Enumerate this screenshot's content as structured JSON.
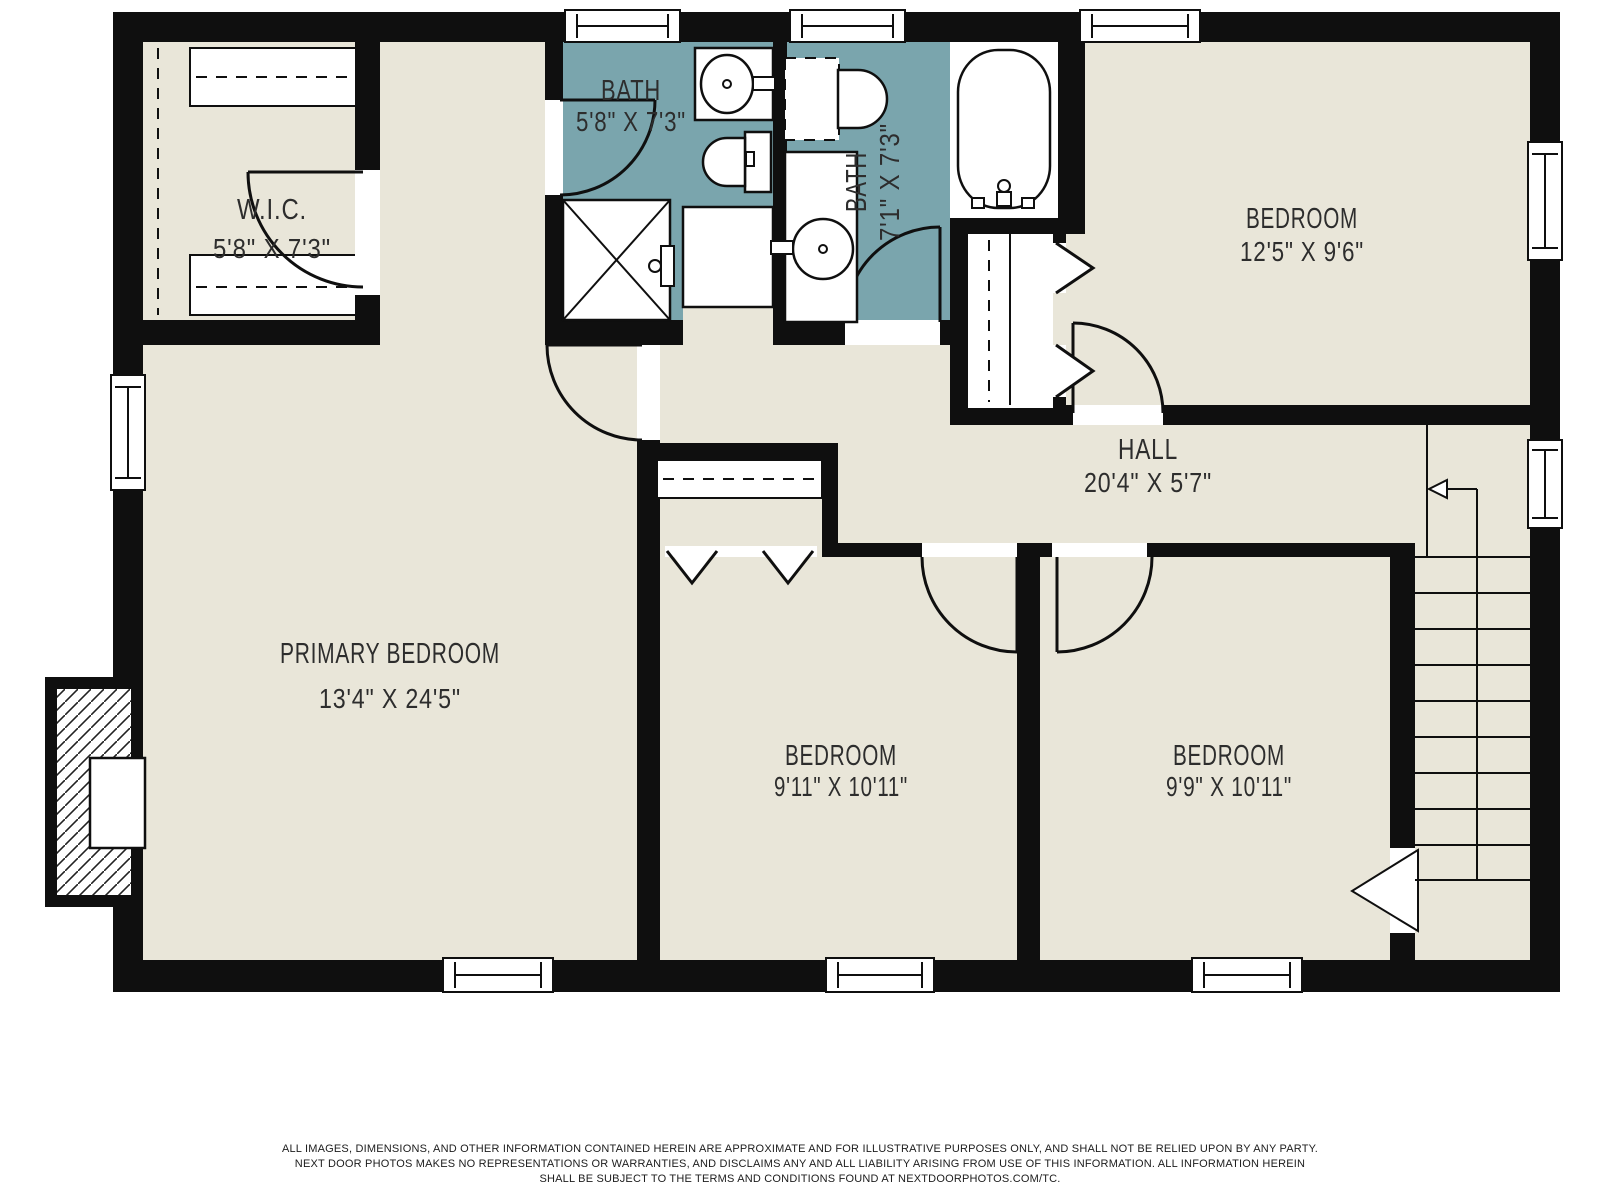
{
  "colors": {
    "wall": "#0f0f0f",
    "floor": "#e9e6d9",
    "bath": "#7aa5ad",
    "text": "#2d2d2d"
  },
  "rooms": {
    "wic": {
      "name": "W.I.C.",
      "dims": "5'8\" X 7'3\""
    },
    "bath1": {
      "name": "BATH",
      "dims": "5'8\" X 7'3\""
    },
    "bath2": {
      "name": "BATH",
      "dims": "7'1\" X 7'3\""
    },
    "bedroom_top": {
      "name": "BEDROOM",
      "dims": "12'5\" X 9'6\""
    },
    "hall": {
      "name": "HALL",
      "dims": "20'4\" X 5'7\""
    },
    "primary": {
      "name": "PRIMARY BEDROOM",
      "dims": "13'4\" X 24'5\""
    },
    "bedroom_mid": {
      "name": "BEDROOM",
      "dims": "9'11\" X 10'11\""
    },
    "bedroom_right": {
      "name": "BEDROOM",
      "dims": "9'9\" X 10'11\""
    }
  },
  "fixtures": [
    "sink",
    "toilet",
    "shower",
    "vanity-sink",
    "bathtub",
    "stairs",
    "fireplace-chimney"
  ],
  "disclaimer": {
    "line1": "ALL IMAGES, DIMENSIONS, AND OTHER INFORMATION CONTAINED HEREIN ARE APPROXIMATE AND FOR ILLUSTRATIVE PURPOSES ONLY, AND SHALL NOT BE RELIED UPON BY ANY PARTY.",
    "line2": "NEXT DOOR PHOTOS MAKES NO REPRESENTATIONS OR WARRANTIES, AND DISCLAIMS ANY AND ALL LIABILITY ARISING FROM USE OF THIS INFORMATION. ALL INFORMATION HEREIN",
    "line3": "SHALL BE SUBJECT TO THE TERMS AND CONDITIONS FOUND AT NEXTDOORPHOTOS.COM/TC."
  }
}
